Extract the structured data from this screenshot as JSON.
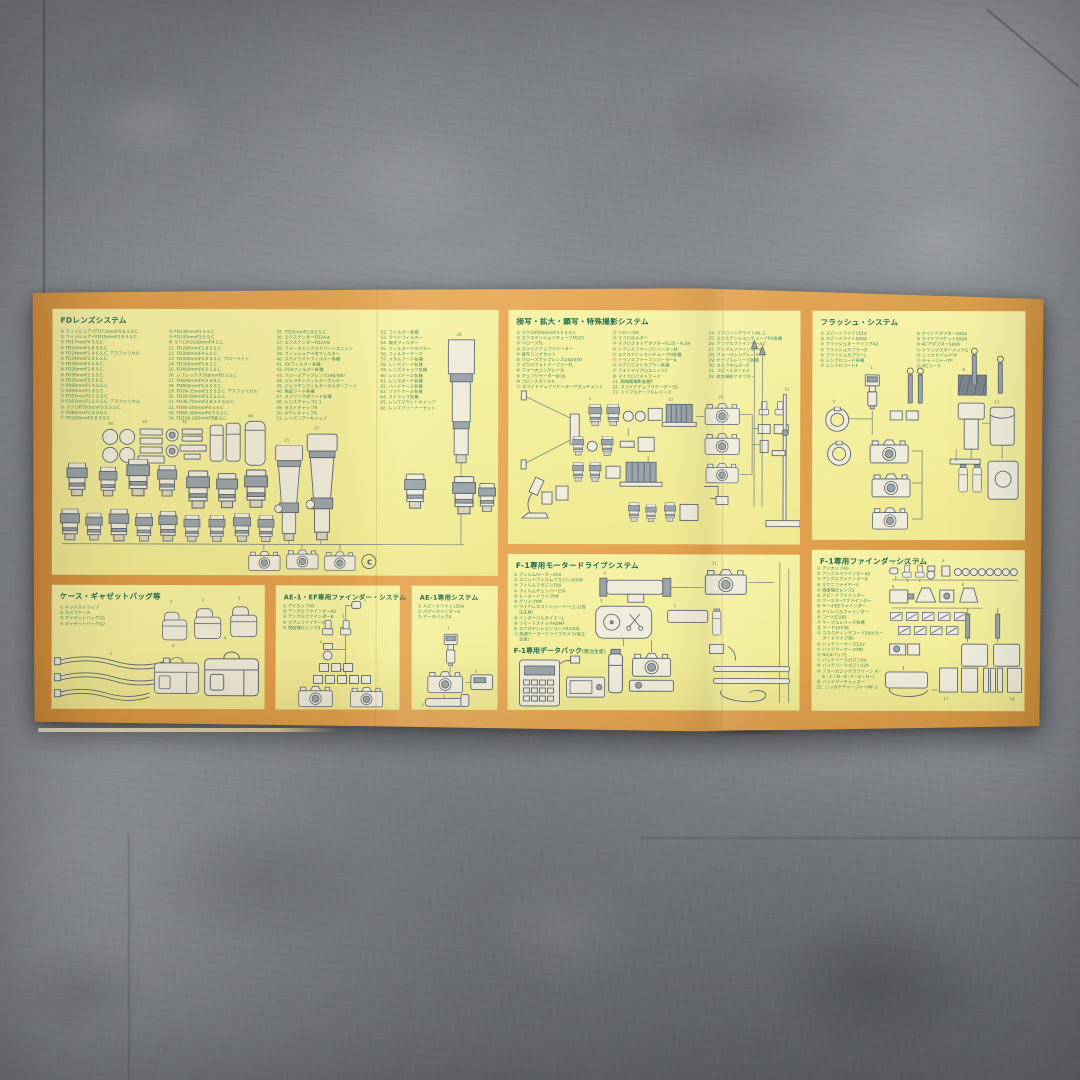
{
  "colors": {
    "floor_gray": "#8a8d91",
    "paper_orange": "#e3a24e",
    "panel_yellow": "#f3ee9c",
    "heading_green": "#1e6e52",
    "list_green": "#3e8a5f",
    "line_ink": "#5d6b73"
  },
  "panels": {
    "fd": {
      "title": "FDレンズシステム",
      "mark": "c",
      "columns": [
        [
          "フィッシュアイFD7.5mmF5.6 S.S.C.",
          "フィッシュアイFD15mmF2.8 S.S.C.",
          "FD17mmF4 S.S.C.",
          "FD20mmF2.8 S.S.C.",
          "FD24mmF1.4 S.S.C. アスフェリカル",
          "FD24mmF2.8 S.S.C.",
          "FD28mmF2 S.S.C.",
          "FD28mmF2.8 S.C.",
          "FD35mmF2 S.S.C.",
          "FD35mmF3.5 S.C.",
          "FD50mmF1.4 S.S.C.",
          "FD50mmF1.8 S.C.",
          "FD55mmF1.2 S.S.C.",
          "FD55mmF1.2 S.S.C. アスフェリカル",
          "マクロFD50mmF3.5 S.S.C.",
          "FD85mmF1.8 S.S.C.",
          "FD100mmF2.8 S.S.C."
        ],
        [
          "FD135mmF2.5 S.C.",
          "FD135mmF3.5 S.C.",
          "マクロFD100mmF4 S.C.",
          "FD200mmF2.8 S.S.C.",
          "FD200mmF4 S.S.C.",
          "FD300mmF2.8 S.S.C. フローライト",
          "FD300mmF5.6 S.C.",
          "FD400mmF4.5 S.S.C.",
          "レフレックス500mmF8 S.S.C.",
          "FD600mmF4.5 S.S.C.",
          "FD800mmF5.6 S.S.C.",
          "FD24-35mmF3.5 S.S.C. アスフェリカル",
          "FD28-50mmF3.5 S.S.C.",
          "FD35-70mmF2.8-3.5 S.S.C.",
          "FD80-200mmF4 S.S.C.",
          "FD85-300mmF4.5 S.S.C.",
          "FD100-200mmF5.6 S.C."
        ],
        [
          "TS35mmF2.8 S.S.C.",
          "エクステンダーFD2X-A",
          "エクステンダーFD2X-B",
          "フォーカシングスクリーンユニット",
          "フィッシュアイ用フィルター",
          "スカイライトフィルター各種",
          "UVフィルター各種",
          "CCAフィルター各種",
          "クローズアップレンズ240/450",
          "ジェラチンフィルターホルダー",
          "ジェラチンフィルターホルダーフード",
          "角型フード各種",
          "スプリング式フード各種",
          "レンズキャップC-1",
          "ダストキャップR",
          "ボディキャップR",
          "レンズリアーキャップ"
        ],
        [
          "フィルター各種",
          "ワイドフィルター",
          "偏光フィルター",
          "フィルターアダプター",
          "フィルターケース",
          "メタルフード各種",
          "レンズフード各種",
          "レンズキャップ各種",
          "レンズケース各種",
          "レンズポーチ各種",
          "ハードケース各種",
          "ソフトケース各種",
          "ストラップ各種",
          "レンズマウントキャップ",
          "レンズクリーナーセット"
        ]
      ]
    },
    "macro": {
      "title": "接写・拡大・顕写・特殊撮影システム",
      "columns": [
        [
          "マクロFD50mmF3.5 S.S.C.",
          "エクステンションチューブFD25",
          "ベローズFL",
          "スライドデュプリケーター",
          "接写リングセット",
          "クローズアップレンズ240/450",
          "マクロフォトクープラーFL",
          "フォーカシングレール",
          "デュプリケーター8/16",
          "コピースタンド4",
          "スライドデュプリケーターアタッチメント"
        ],
        [
          "ベローズM",
          "マクロホルダー",
          "マクロフォトアダプターFL35・FL34",
          "トランスファーコンバーターM",
          "エクステンションチューブM各種",
          "トランスファーコンバーターA",
          "マクロフォトカプラー各種",
          "フォトマイクロユニットF",
          "マイクロフォトフード",
          "顕微鏡撮影装置F",
          "スライドデュプリケーター35",
          "トリプルケーブルレリーズ"
        ],
        [
          "マクロリングライトML-1",
          "エクステンションチューブFD各種",
          "アングルファインダーA2",
          "アングルファインダーB",
          "フォーカシングレールFN",
          "ケーブルレリーズ各種",
          "カメラホルダーF",
          "コピースタンド4",
          "拡大撮影アダプター"
        ]
      ]
    },
    "flash": {
      "title": "フラッシュ・システム",
      "columns": [
        [
          "スピードライト155A",
          "スピードライト500A",
          "フラッシュオートリングA2",
          "フラッシュカプラーD",
          "フラッシュカプラーL",
          "シンクロコード各種",
          "シンクロコードF"
        ],
        [
          "ワイドアダプター500A",
          "サイドブラケット500A",
          "ACアダプター500A",
          "トランジスターパックG",
          "ニッカドパックTP",
          "チャージャーTP",
          "DCコード"
        ]
      ]
    },
    "cases": {
      "title": "ケース・ギャゼットバッグ等",
      "columns": [
        [
          "ネックストラップ",
          "カメラケース",
          "ギャゼットバッグG1",
          "ギャゼットバッグG2"
        ]
      ]
    },
    "ae1ef": {
      "title": "AE-1・EF専用ファインダー・システム",
      "columns": [
        [
          "アイカップ4S",
          "アングルファインダーA2",
          "アングルファインダーB",
          "マグニファイヤーS",
          "視度補正レンズS"
        ]
      ]
    },
    "ae1": {
      "title": "AE-1専用システム",
      "columns": [
        [
          "スピードライト155A",
          "パワーワインダーA",
          "データバックA"
        ]
      ]
    },
    "f1motor": {
      "title": "F-1専用モータードライブシステム",
      "subtitle": "F-1専用データバック",
      "subtitle_note": "(受注生産)",
      "columns": [
        [
          "フィルムローダー250",
          "ユニットフィルムマガジン250用",
          "フィルムマガジン250",
          "フィルムチェンバー250",
          "モータードライブMF",
          "グリップMF",
          "ワイヤレスコントローラーLC-1(受注生産)",
          "インターバルタイマーL",
          "リモートスイッチ60MF",
          "エクステンションコードE1000",
          "高速モータードライブカメラ(受注生産)"
        ]
      ]
    },
    "f1finder": {
      "title": "F-1専用ファインダーシステム",
      "columns": [
        [
          "アイカップ4S",
          "アングルファインダーA2",
          "アングルファインダーB",
          "マグニファイヤーS",
          "視度補正レンズS",
          "スピードファインダー",
          "ブースターTファインダー",
          "サーボEEファインダー",
          "アイレベルファインダー",
          "コードE10D",
          "ケーブルレリーズ各種",
          "コード12V3E",
          "コネクティングコード500(モータードライブ用)",
          "バッテリーケース12V",
          "バッテリーケースMD",
          "NiCdパックJ",
          "バッテリーマガジン6V",
          "バッテリーマガジン12V",
          "フォーカシングスクリーン A・B・C・D・E・F・G・H・I",
          "バッテリーチェッカー",
          "ニッカドチャージャーMF-2"
        ]
      ]
    }
  }
}
